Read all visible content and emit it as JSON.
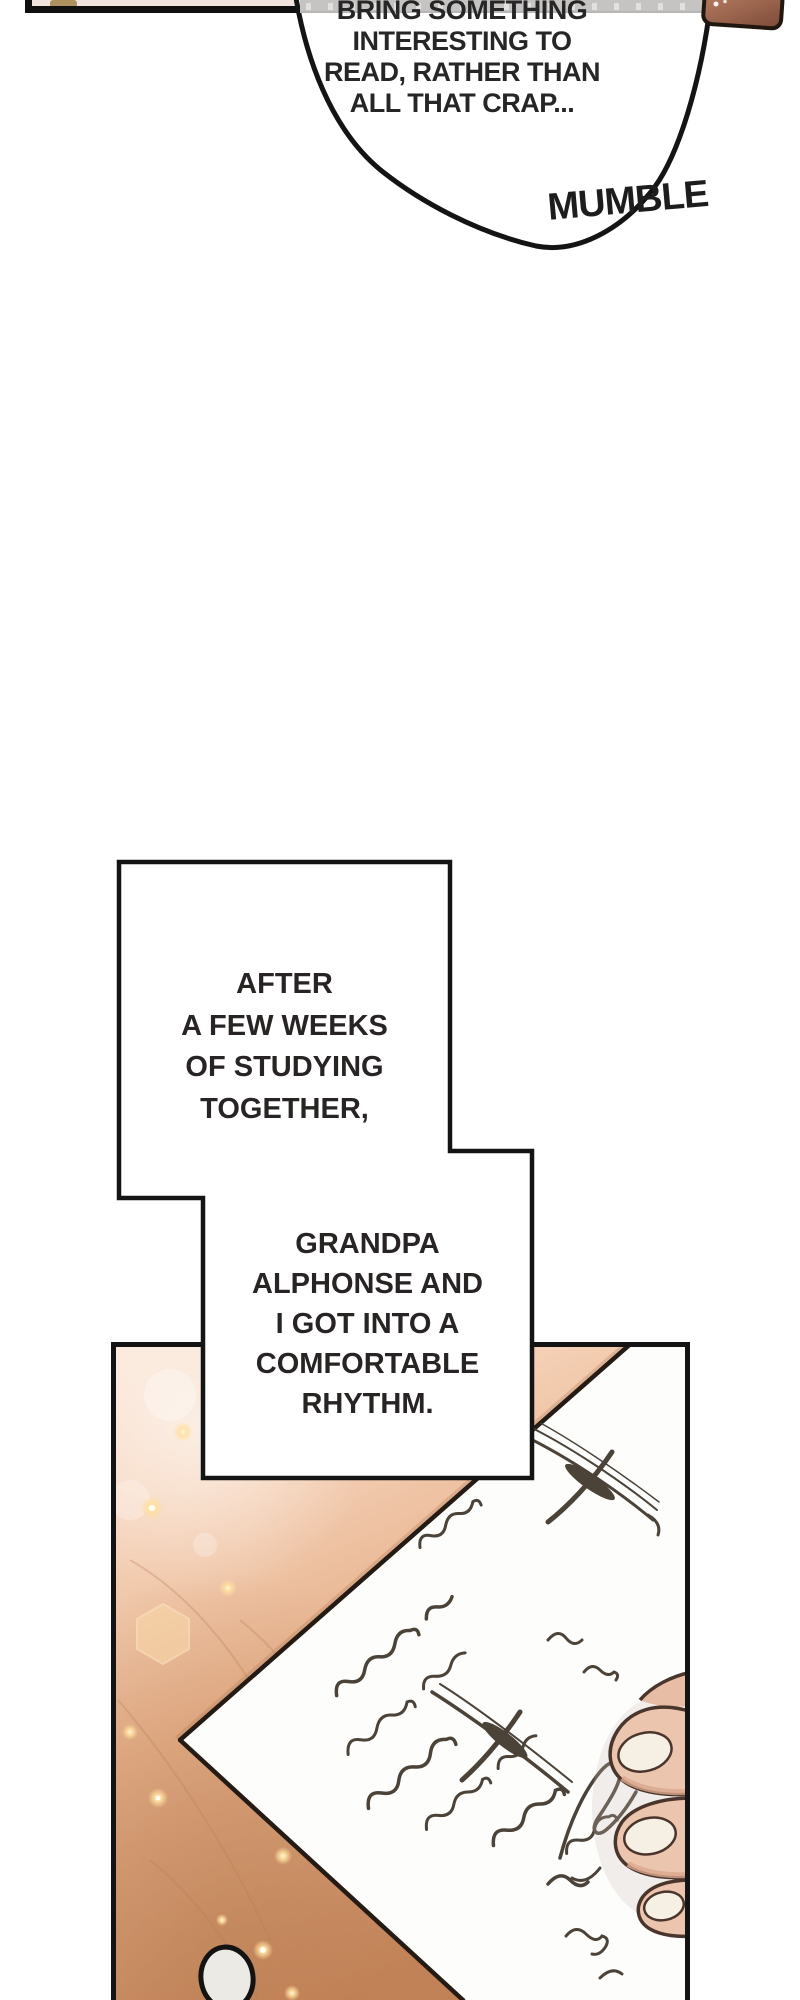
{
  "comic": {
    "speech_bubble": {
      "lines": [
        "BRING SOMETHING",
        "INTERESTING TO",
        "READ, RATHER THAN",
        "ALL THAT CRAP..."
      ],
      "sfx_label": "MUMBLE"
    },
    "narration_boxes": {
      "box1_lines": [
        "AFTER",
        "A FEW WEEKS",
        "OF STUDYING",
        "TOGETHER,"
      ],
      "box2_lines": [
        "GRANDPA",
        "ALPHONSE AND",
        "I GOT INTO A",
        "COMFORTABLE",
        "RHYTHM."
      ]
    },
    "art": {
      "panel_description": "hand resting on a handwritten letter on a wooden desk",
      "colors": {
        "outline": "#141414",
        "text": "#262626",
        "wood_light": "#fbe3d2",
        "wood_dark": "#c5845a",
        "paper": "#fdfdfc",
        "ink": "#4b4238",
        "skin": "#ecc5ae",
        "nail": "#f6efe3",
        "shelf_gray": "#c6c4c3",
        "book_brown": "#a06a50",
        "sparkle": "#ffdf9e"
      }
    }
  }
}
